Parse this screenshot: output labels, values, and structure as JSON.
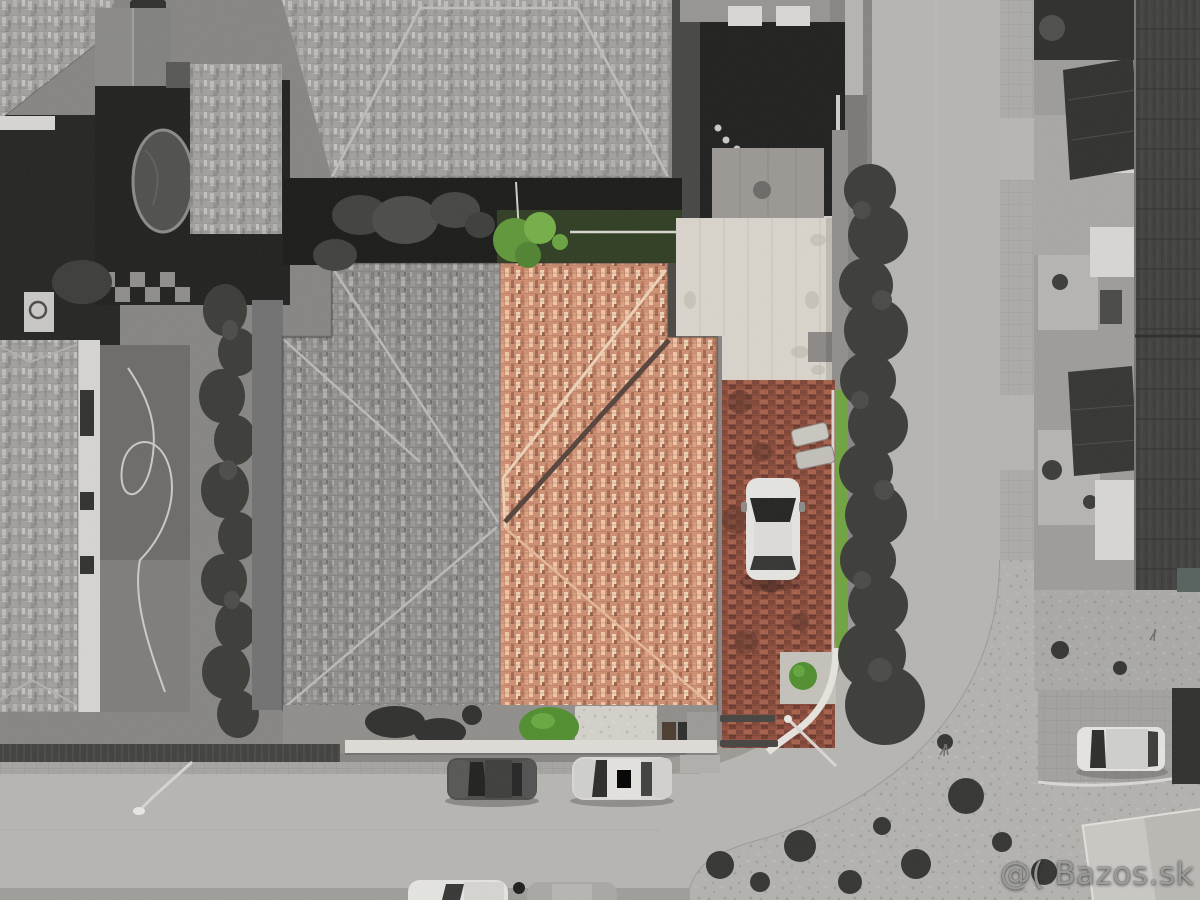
{
  "meta": {
    "title": "Aerial drone photo of a street corner property",
    "style": "selective color: highlighted house in color, surroundings desaturated"
  },
  "watermark": {
    "text": "@( Bazos.sk"
  },
  "colors": {
    "asphalt": "#b6b4b1",
    "sidewalk": "#a5a3a0",
    "roof-gray": "#8d8c8a",
    "roof-light": "#a09f9d",
    "roof-terracotta": "#cd8e71",
    "roof-terracotta-light": "#eec4a4",
    "roof-terracotta-dark": "#a4684f",
    "brick-driveway": "#96503e",
    "grass-green": "#6fa23f",
    "bush-green": "#4f8d2d",
    "carport-white": "#d8d4ca",
    "dark-roof": "#3f3f3d",
    "yard-dark": "#1e1e1d",
    "hedge": "#3a3a37",
    "car-white": "#e4e3e0",
    "car-dark": "#4b4b49",
    "car-silver": "#d8d7d4",
    "wall-white": "#dedbd6"
  },
  "scene": {
    "highlighted_property": "right half of central duplex with terracotta roof, brick driveway, green garden",
    "vehicles": [
      "white car on brick driveway",
      "dark car parked on street",
      "silver car parked on street",
      "white car in corner driveway",
      "two partial cars at bottom edge",
      "dark car at top edge"
    ]
  }
}
